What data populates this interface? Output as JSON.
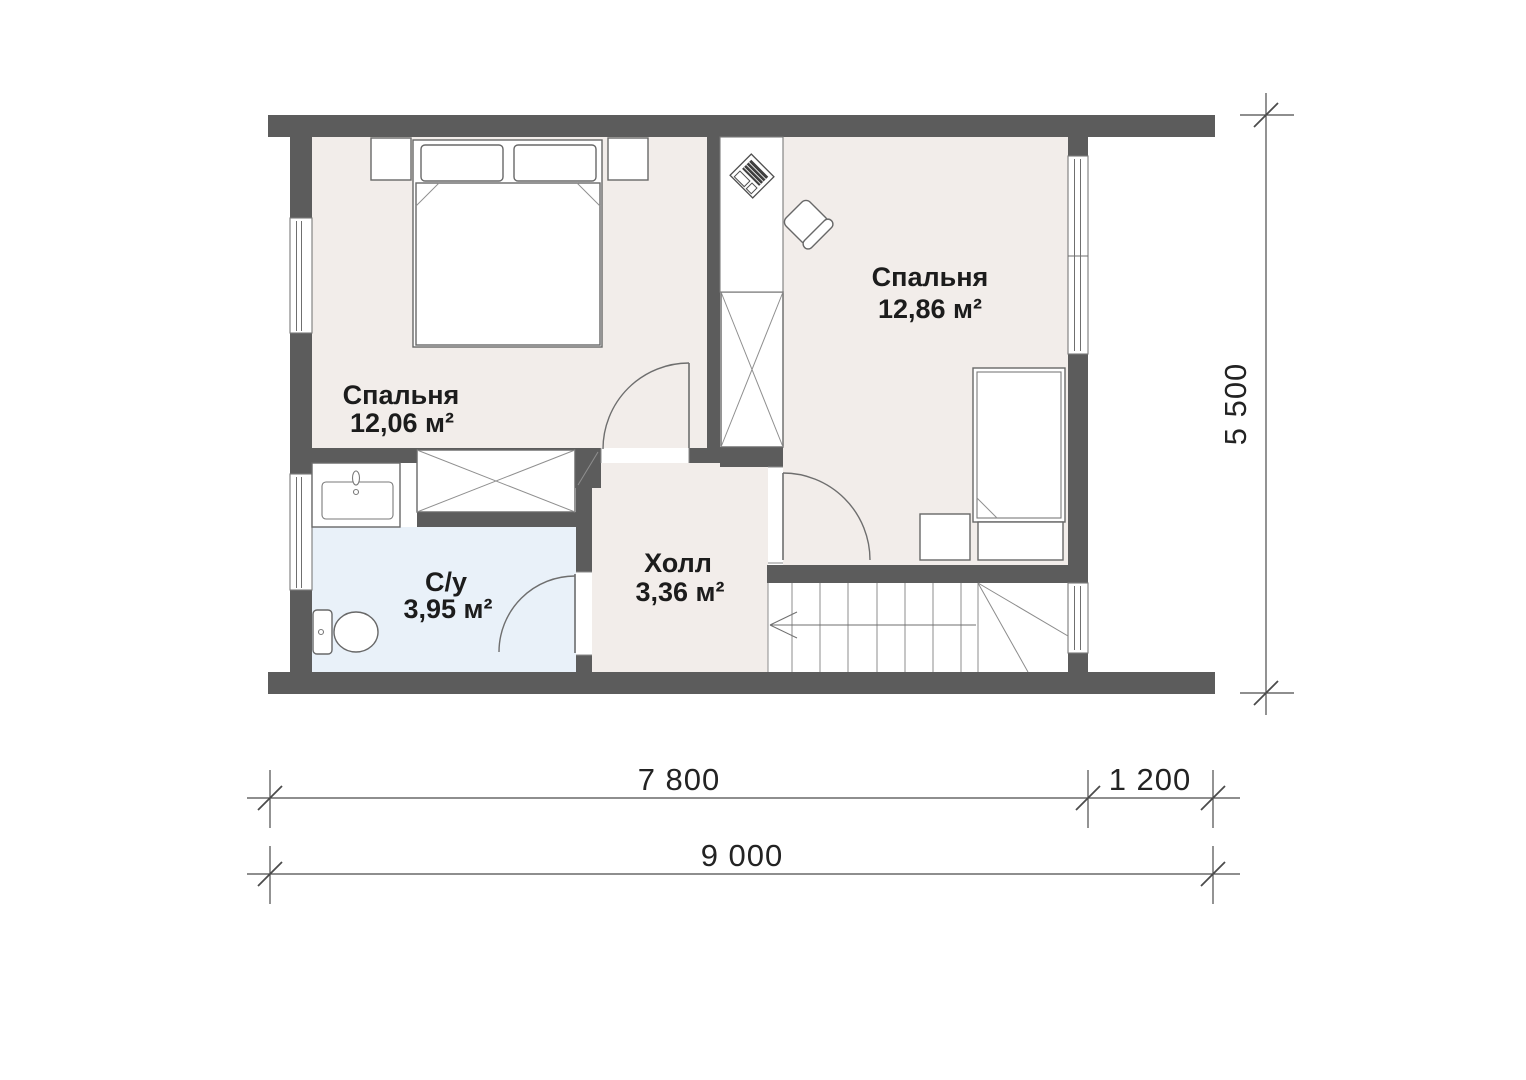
{
  "plan": {
    "type": "floor-plan",
    "rooms": [
      {
        "id": "bedroom-1",
        "name": "Спальня",
        "area": "12,06 м²"
      },
      {
        "id": "bedroom-2",
        "name": "Спальня",
        "area": "12,86 м²"
      },
      {
        "id": "bathroom",
        "name": "С/у",
        "area": "3,95 м²"
      },
      {
        "id": "hall",
        "name": "Холл",
        "area": "3,36 м²"
      }
    ],
    "dimensions": {
      "width_main": "7 800",
      "width_ext": "1 200",
      "width_total": "9 000",
      "height_total": "5 500"
    },
    "colors": {
      "wall": "#5c5c5c",
      "room_floor": "#f2edea",
      "bathroom_floor": "#e9f1f9",
      "furniture_outline": "#686868",
      "dimension_line": "#4b4b4b",
      "label_text": "#1c1c1c",
      "background": "#ffffff"
    },
    "icons": [
      "double-bed-icon",
      "pillow-icon",
      "nightstand-icon",
      "wardrobe-x-icon",
      "desk-icon",
      "laptop-icon",
      "office-chair-icon",
      "single-bed-icon",
      "sink-icon",
      "toilet-icon",
      "stairs-icon",
      "stairs-arrow-icon",
      "door-swing-icon",
      "window-icon"
    ]
  }
}
